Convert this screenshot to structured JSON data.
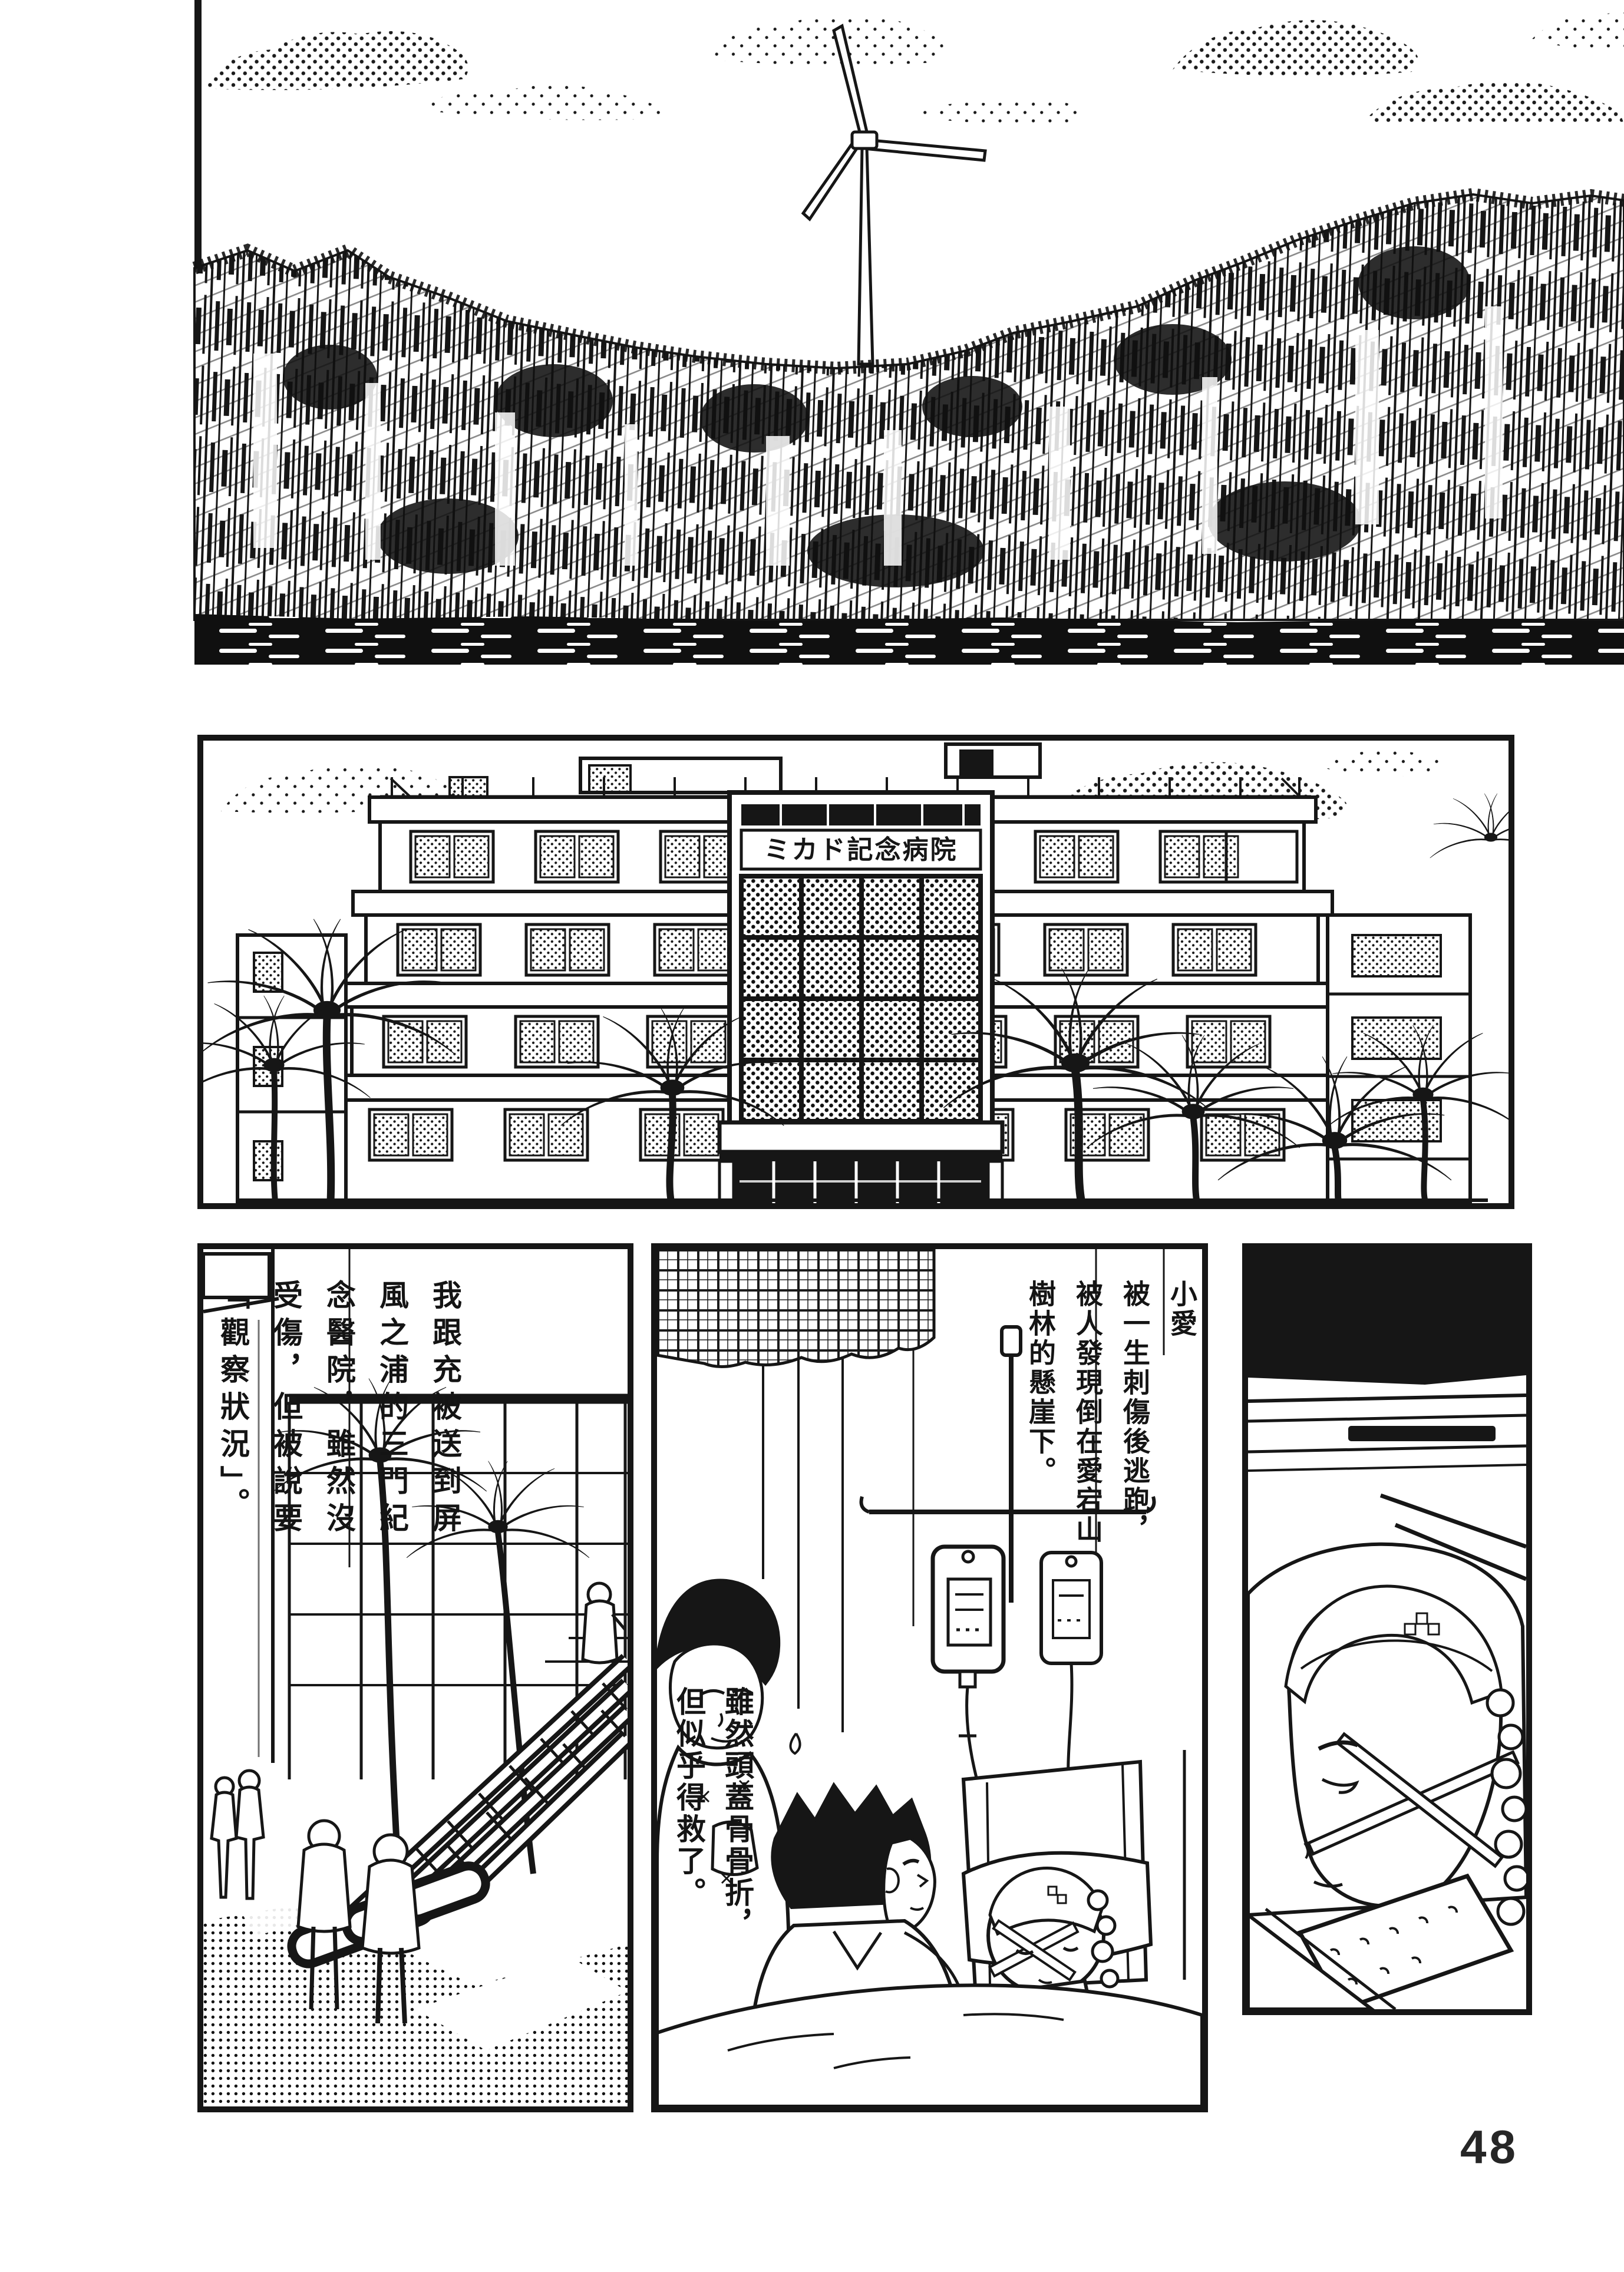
{
  "page_number": "48",
  "hospital": {
    "sign": "ミカド記念病院"
  },
  "captions": {
    "sent_to_hospital": {
      "columns": [
        "我跟充被送到屏",
        "風之浦的三門紀",
        "念醫院，雖然沒",
        "受傷，但被說要",
        "「觀察狀況」。"
      ]
    },
    "found_on_cliff": {
      "columns": [
        "小愛",
        "被一生刺傷後逃跑，",
        "被人發現倒在愛宕山",
        "樹林的懸崖下。"
      ]
    },
    "skull_fracture": {
      "columns": [
        "雖然頭蓋骨骨折，",
        "但似乎得救了。"
      ]
    }
  },
  "colors": {
    "ink": "#161616",
    "paper": "#ffffff"
  }
}
